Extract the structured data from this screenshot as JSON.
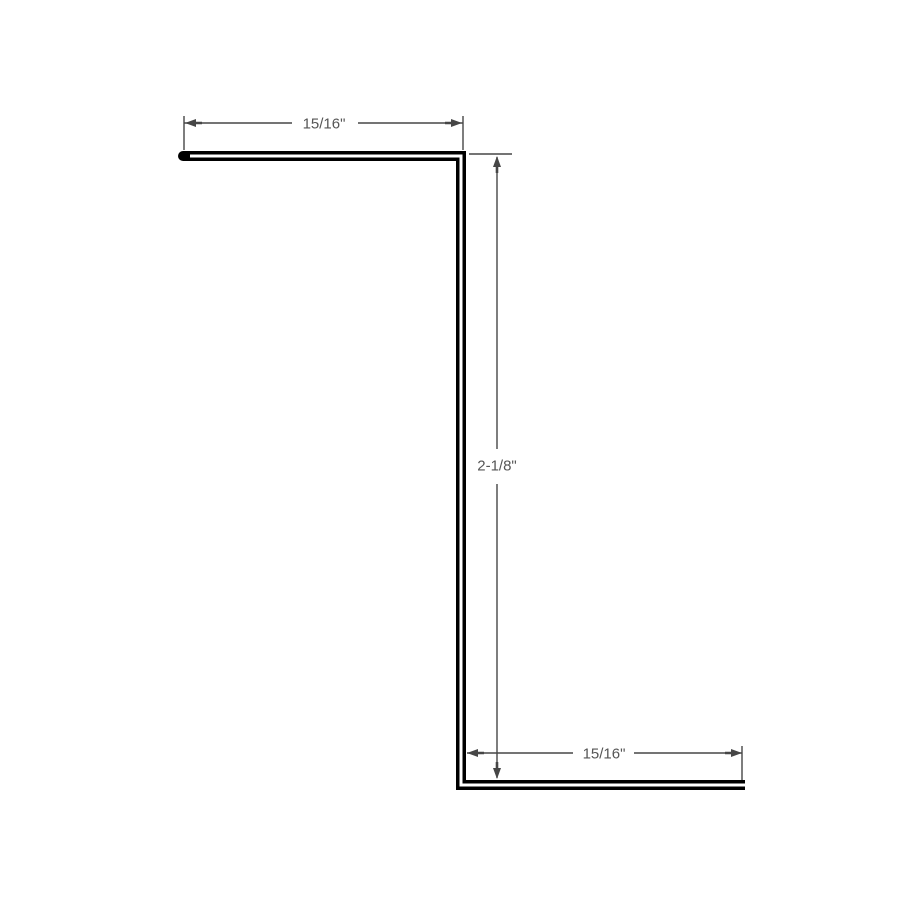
{
  "diagram": {
    "kind": "z-flashing-profile-drawing",
    "background_color": "#ffffff",
    "profile_color": "#000000",
    "dimension_line_color": "#464646",
    "dimension_text_color": "#555555",
    "dimensions": {
      "top_flange": {
        "label": "15/16\""
      },
      "web_height": {
        "label": "2-1/8\""
      },
      "bottom_flange": {
        "label": "15/16\""
      }
    }
  }
}
